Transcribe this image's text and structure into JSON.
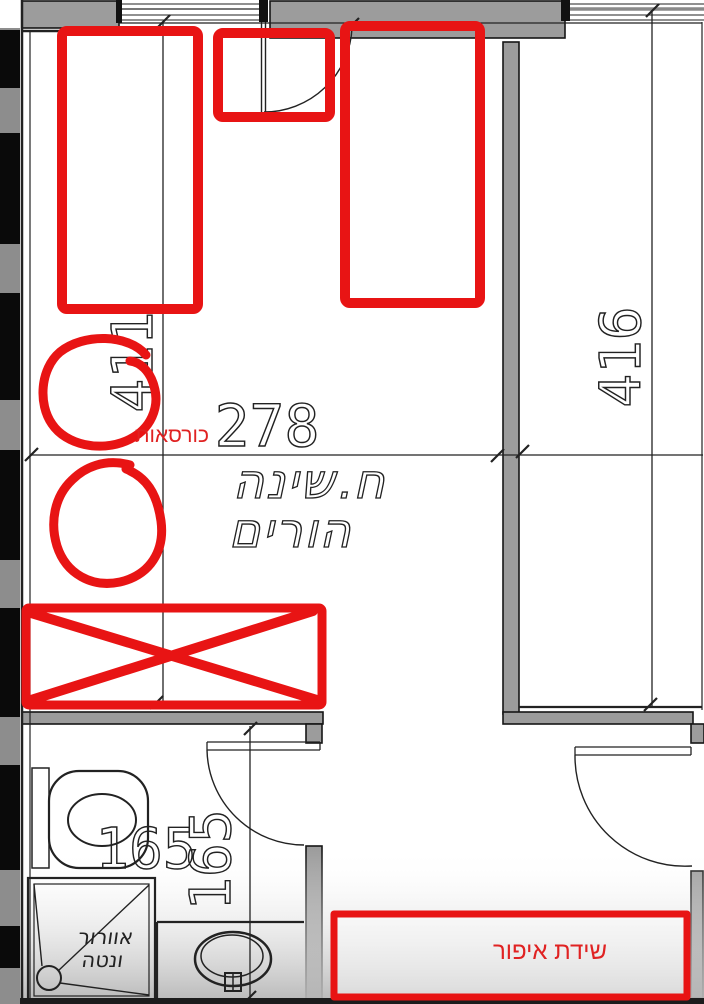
{
  "plan": {
    "room_label": {
      "line1": "ח.שינה",
      "line2": "הורים"
    },
    "dimensions": {
      "bedroom_width": "278",
      "bedroom_left_height": "411",
      "bedroom_right_height": "416",
      "bathroom_width": "165",
      "bathroom_depth": "165"
    },
    "bathroom": {
      "shower_note_line1": "אוורור",
      "shower_note_line2": "ונטה"
    },
    "annotations": {
      "color": "#e81414",
      "armchairs_label": "כורסאות",
      "makeup_dresser_label": "שידת איפור"
    }
  }
}
